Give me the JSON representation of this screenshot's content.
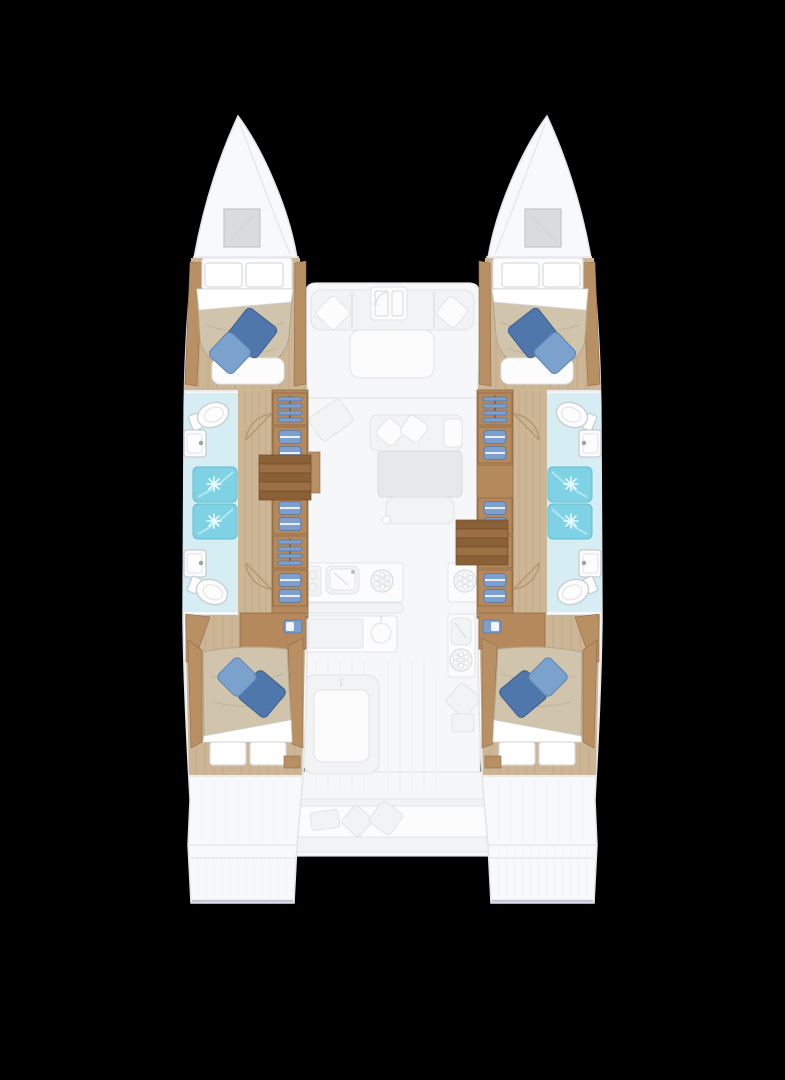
{
  "canvas": {
    "width": 785,
    "height": 1080
  },
  "plan": {
    "type": "catamaran-floorplan-top-view",
    "hulls": 2,
    "cabins": 4,
    "double_beds": 4,
    "toilets": 4,
    "showers": 4,
    "sinks": 4,
    "wardrobes": 8,
    "companionway_stairs": 2,
    "center_features": [
      "bow-hatch",
      "forward-cockpit-seating",
      "saloon-sofa",
      "saloon-chaise",
      "saloon-dining-table",
      "saloon-bench",
      "galley-sink",
      "galley-stove-burner",
      "galley-island",
      "aft-galley-module",
      "aft-cockpit-table",
      "aft-bench-seat",
      "swim-transoms"
    ]
  },
  "colors": {
    "background": "#000000",
    "hull_white": "#f8f9fa",
    "hull_stroke": "#e2e4e8",
    "deck_white": "#f6f7f9",
    "deck_line": "#e6e8eb",
    "deck_stripe": "#eef0f2",
    "ghost_furniture": "#f2f3f5",
    "ghost_stroke": "#e0e3e6",
    "table_gray": "#e7e8ea",
    "hatch_gray": "#d9dbdd",
    "wood_floor": "#cdb695",
    "wood_plank": "#bda27c",
    "wood_trim": "#b99064",
    "cabinet_wood": "#b6895c",
    "cabinet_line": "#8f6a45",
    "stair_dark": "#8a6137",
    "stair_light": "#9c7044",
    "duvet_beige": "#d0c4ad",
    "duvet_line": "#b3a68c",
    "pillow_white": "#ffffff",
    "pillow_stroke": "#d9dadc",
    "pillow_blue_dark": "#4f77ac",
    "pillow_blue_light": "#7ba1cd",
    "bath_floor": "#d6edf3",
    "shower_cyan": "#7ed2e4",
    "fixture_white": "#fdfdfe",
    "fixture_stroke": "#c7cdd1",
    "clothes_blue": "#7d9fd0",
    "door_brown": "#b29069",
    "transom_ridge": "#e9ebee",
    "transom_edge": "#c4cbd5"
  }
}
